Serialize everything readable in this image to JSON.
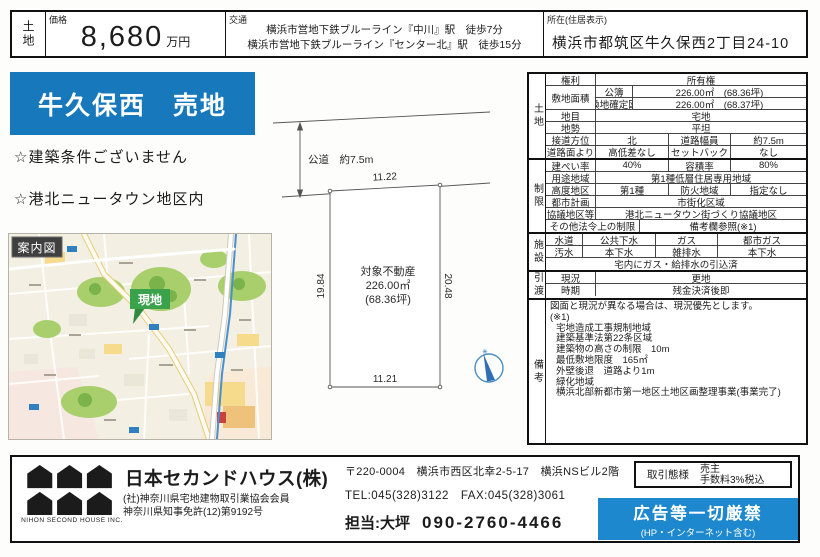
{
  "colors": {
    "banner_blue": "#1878bc",
    "adban_blue": "#1e88cf",
    "marker_green": "#3aa24b"
  },
  "top_bar": {
    "category": "土地",
    "price_label": "価格",
    "price_value": "8,680",
    "price_unit": "万円",
    "access_label": "交通",
    "access_lines": [
      "横浜市営地下鉄ブルーライン『中川』駅　徒歩7分",
      "横浜市営地下鉄ブルーライン『センター北』駅　徒歩15分"
    ],
    "location_label": "所在(住居表示)",
    "location_value": "横浜市都筑区牛久保西2丁目24-10"
  },
  "left": {
    "banner_title": "牛久保西　売地",
    "points": [
      "☆建築条件ございません",
      "☆港北ニュータウン地区内"
    ],
    "map_label": "案内図",
    "marker_label": "現地"
  },
  "plot": {
    "road_label": "公道　約7.5m",
    "top_dim": "11.22",
    "bottom_dim": "11.21",
    "left_dim": "19.84",
    "right_dim": "20.48",
    "center_lines": [
      "対象不動産",
      "226.00㎡",
      "(68.36坪)"
    ],
    "compass_mark": "✳"
  },
  "details": {
    "group_labels": {
      "land": "土地",
      "restrictions": "制限",
      "facilities": "施設",
      "handover": "引渡",
      "remarks": "備考"
    },
    "rows": [
      {
        "l": "権利",
        "v": "所有権"
      },
      {
        "l": "敷地面積",
        "s": "公簿",
        "v": "226.00㎡　(68.36坪)"
      },
      {
        "s": "換地確定図",
        "v": "226.00㎡　(68.37坪)"
      },
      {
        "l": "地目",
        "v": "宅地"
      },
      {
        "l": "地勢",
        "v": "平坦"
      },
      {
        "l": "接道方位",
        "a": "北",
        "b": "道路幅員",
        "c": "約7.5m"
      },
      {
        "l": "道路面より",
        "a": "高低差なし",
        "b": "セットバック",
        "c": "なし"
      },
      {
        "l": "建ぺい率",
        "a": "40%",
        "b": "容積率",
        "c": "80%"
      },
      {
        "l": "用途地域",
        "v": "第1種低層住居専用地域"
      },
      {
        "l": "高度地区",
        "a": "第1種",
        "b": "防火地域",
        "c": "指定なし"
      },
      {
        "l": "都市計画",
        "v": "市街化区域"
      },
      {
        "l": "協議地区等",
        "v": "港北ニュータウン街づくり協議地区"
      },
      {
        "l": "その他法令上の制限",
        "v": "備考欄参照(※1)"
      },
      {
        "l": "水道",
        "a": "公共下水",
        "b": "ガス",
        "c": "都市ガス"
      },
      {
        "l": "汚水",
        "a": "本下水",
        "b": "雑排水",
        "c": "本下水"
      },
      {
        "v": "宅内にガス・給排水の引込済"
      },
      {
        "l": "現況",
        "v": "更地"
      },
      {
        "l": "時期",
        "v": "残金決済後即"
      }
    ],
    "remarks": {
      "note": "図面と現況が異なる場合は、現況優先とします。",
      "ref": "(※1)",
      "items": [
        "宅地造成工事規制地域",
        "建築基準法第22条区域",
        "建築物の高さの制限　10m",
        "最低敷地限度　165㎡",
        "外壁後退　道路より1m",
        "緑化地域",
        "横浜北部新都市第一地区土地区画整理事業(事業完了)"
      ]
    }
  },
  "footer": {
    "company": "日本セカンドハウス(株)",
    "memberships": [
      "(社)神奈川県宅地建物取引業協会会員",
      "神奈川県知事免許(12)第9192号"
    ],
    "logo_caption": "NIHON SECOND HOUSE INC.",
    "address": "〒220-0004　横浜市西区北幸2-5-17　横浜NSビル2階",
    "tel_fax": "TEL:045(328)3122　FAX:045(328)3061",
    "contact_label": "担当:大坪",
    "contact_phone": "090-2760-4466",
    "deal_type_label": "取引態様",
    "deal_type_value": "売主",
    "deal_fee": "手数料3%税込",
    "ad_ban_title": "広告等一切厳禁",
    "ad_ban_sub": "(HP・インターネット含む)"
  }
}
